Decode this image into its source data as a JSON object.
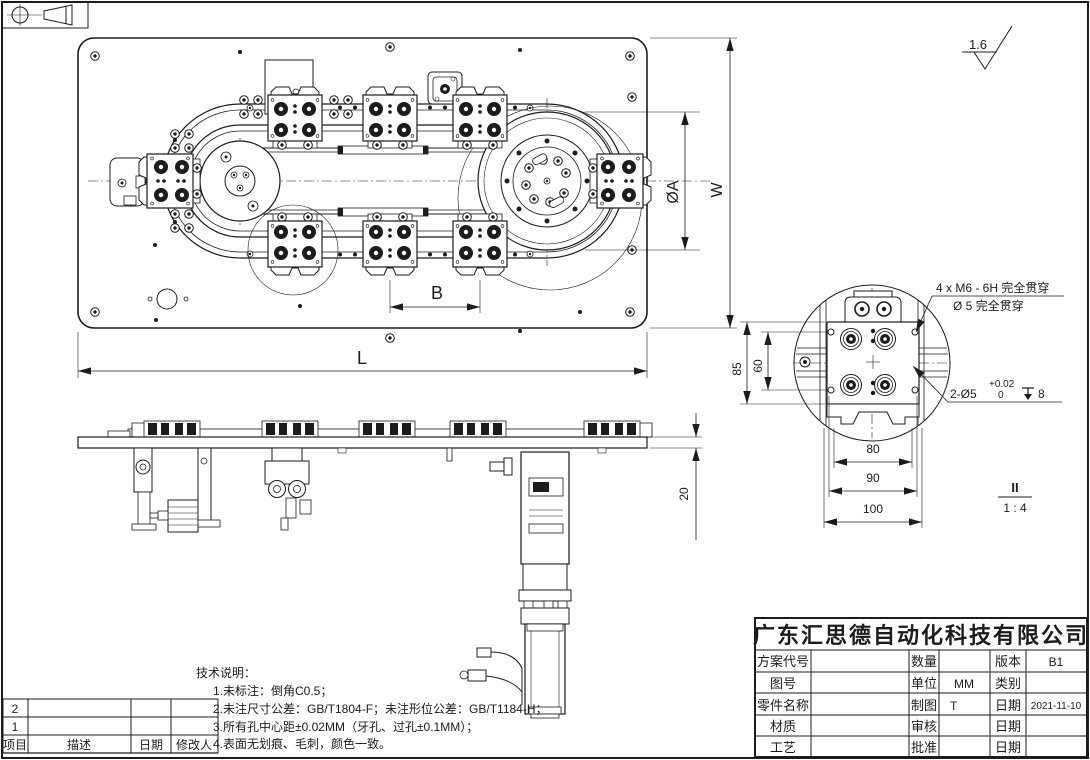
{
  "sheet": {
    "background": "#ffffff",
    "ink": "#1c1c1c"
  },
  "projection_symbol": {
    "name": "first-angle-projection"
  },
  "surface_finish": {
    "roughness": "1.6"
  },
  "top_view": {
    "dim_length": "L",
    "dim_width": "W",
    "dim_dial_diameter": "ØA",
    "dim_fixture_pitch": "B"
  },
  "front_view": {
    "dim_plate_thickness": "20"
  },
  "detail_view": {
    "label": "II",
    "scale": "1 : 4",
    "dim_height": "85",
    "dim_hole_span_vertical": "60",
    "dim_80": "80",
    "dim_90": "90",
    "dim_100": "100",
    "callout_threads_line1": "4 x M6 - 6H 完全贯穿",
    "callout_threads_line2": "Ø 5 完全贯穿",
    "callout_pins_prefix": "2-Ø5",
    "callout_pins_tol_upper": "+0.02",
    "callout_pins_tol_lower": "0",
    "callout_pins_depth": "8"
  },
  "tech_notes": {
    "title": "技术说明：",
    "items": [
      "1.未标注：倒角C0.5；",
      "2.未注尺寸公差：GB/T1804-F；未注形位公差：GB/T1184-H；",
      "3.所有孔中心距±0.02MM（牙孔、过孔±0.1MM）；",
      "4.表面无划痕、毛刺，颜色一致。"
    ]
  },
  "title_block": {
    "company": "广东汇思德自动化科技有限公司",
    "rows": [
      {
        "label": "方案代号",
        "value": "",
        "mlabel": "数量",
        "mvalue": "",
        "rlabel": "版本",
        "rvalue": "B1"
      },
      {
        "label": "图号",
        "value": "",
        "mlabel": "单位",
        "mvalue": "MM",
        "rlabel": "类别",
        "rvalue": ""
      },
      {
        "label": "零件名称",
        "value": "",
        "mlabel": "制图",
        "mvalue": "T",
        "rlabel": "日期",
        "rvalue": "2021-11-10"
      },
      {
        "label": "材质",
        "value": "",
        "mlabel": "审核",
        "mvalue": "",
        "rlabel": "日期",
        "rvalue": ""
      },
      {
        "label": "工艺",
        "value": "",
        "mlabel": "批准",
        "mvalue": "",
        "rlabel": "日期",
        "rvalue": ""
      }
    ]
  },
  "revision_table": {
    "headers": [
      "项目",
      "描述",
      "日期",
      "修改人"
    ],
    "rows": [
      {
        "item": "2",
        "desc": "",
        "date": "",
        "by": ""
      },
      {
        "item": "1",
        "desc": "",
        "date": "",
        "by": ""
      }
    ]
  }
}
